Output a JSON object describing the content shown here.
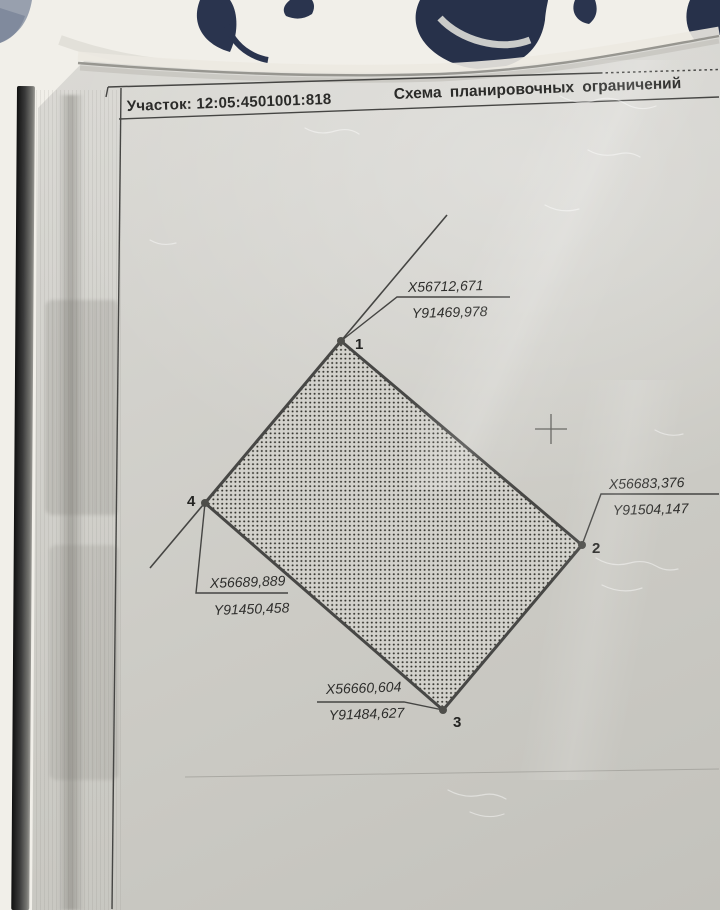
{
  "header": {
    "parcel_label": "Участок: 12:05:4501001:818",
    "title": "Схема планировочных ограничений"
  },
  "parcel": {
    "points": [
      {
        "number": "1",
        "x_label": "X56712,671",
        "y_label": "Y91469,978"
      },
      {
        "number": "2",
        "x_label": "X56683,376",
        "y_label": "Y91504,147"
      },
      {
        "number": "3",
        "x_label": "X56660,604",
        "y_label": "Y91484,627"
      },
      {
        "number": "4",
        "x_label": "X56689,889",
        "y_label": "Y91450,458"
      }
    ]
  },
  "colors": {
    "paper": "#cfcec8",
    "ink": "#3c3c3c",
    "fabric": "#efede7",
    "fabric_pattern": "#2a344e"
  }
}
